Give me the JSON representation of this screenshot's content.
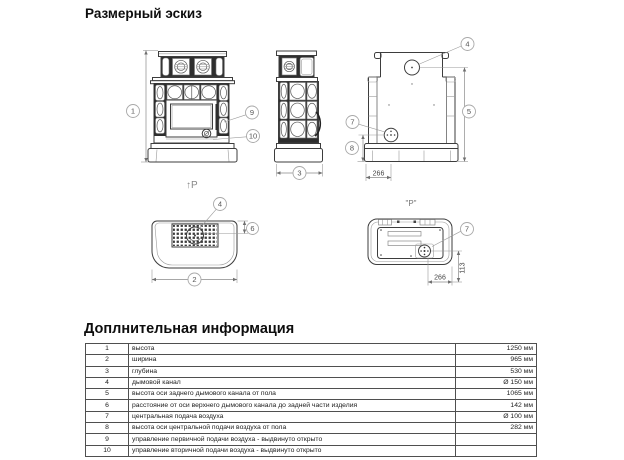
{
  "page": {
    "title": "Размерный эскиз",
    "info_title": "Доплнительная информация"
  },
  "drawing": {
    "front_view_label": "↑Р",
    "p_view_label": "\"Р\"",
    "callouts": {
      "c1": "1",
      "c2": "2",
      "c3": "3",
      "c4": "4",
      "c5": "5",
      "c6": "6",
      "c7": "7",
      "c8": "8",
      "c9": "9",
      "c10": "10"
    },
    "dimensions": {
      "back_width": "266",
      "bottom_width": "266",
      "bottom_offset": "113"
    }
  },
  "table": {
    "rows": [
      {
        "num": "1",
        "name": "высота",
        "value": "1250 мм"
      },
      {
        "num": "2",
        "name": "ширина",
        "value": "965 мм"
      },
      {
        "num": "3",
        "name": "глубина",
        "value": "530 мм"
      },
      {
        "num": "4",
        "name": "дымовой канал",
        "value": "Ø 150 мм"
      },
      {
        "num": "5",
        "name": "высота оси заднего дымового канала от пола",
        "value": "1065 мм"
      },
      {
        "num": "6",
        "name": "расстояние от оси верхнего дымового канала до задней части изделия",
        "value": "142 мм"
      },
      {
        "num": "7",
        "name": "центральная подача воздуха",
        "value": "Ø 100 мм"
      },
      {
        "num": "8",
        "name": "высота оси центральной подачи воздуха от пола",
        "value": "282 мм"
      },
      {
        "num": "9",
        "name": "управление первичной подачи воздуха - выдвинуто открыто",
        "value": ""
      },
      {
        "num": "10",
        "name": "управление вторичной подачи воздуха - выдвинуто открыто",
        "value": ""
      }
    ]
  }
}
